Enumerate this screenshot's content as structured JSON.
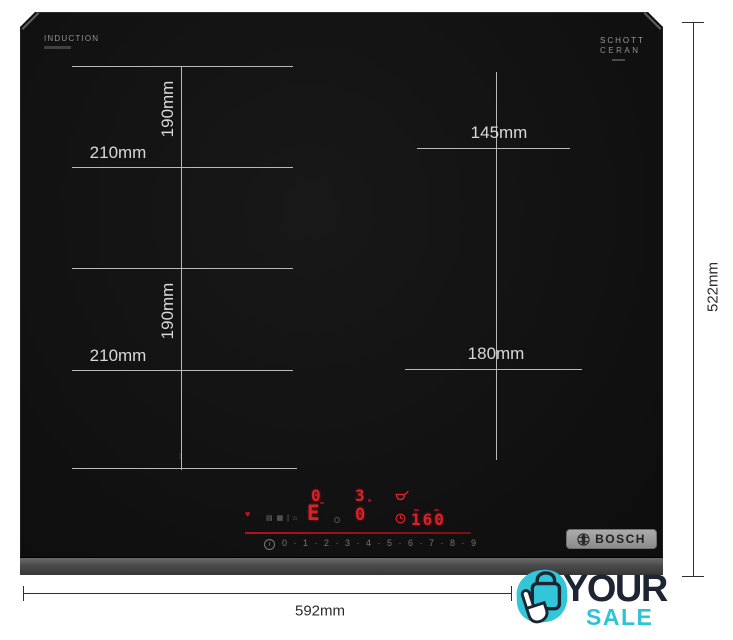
{
  "product": {
    "surface_label": "INDUCTION",
    "brand": "BOSCH",
    "glass_brand_line1": "SCHOTT",
    "glass_brand_line2": "CERAN"
  },
  "measurements": {
    "zone_height": "190mm",
    "zone_width": "210mm",
    "small_zone_width": "145mm",
    "mid_zone_width": "180mm",
    "total_height": "522mm",
    "total_width": "592mm"
  },
  "control_panel": {
    "display_top_left": "0",
    "display_top_right": "3",
    "display_selector": "E",
    "display_mid_right": "0",
    "timer_display": "160",
    "info_symbol": "i",
    "power_scale": [
      "0",
      "1",
      "2",
      "3",
      "4",
      "5",
      "6",
      "7",
      "8",
      "9"
    ],
    "power_scale_text": "0 · 1 · 2 · 3 · 4 · 5 · 6 · 7 · 8 · 9",
    "heat_indicator": "♥",
    "aux_icons_text": "▤ ▦ | ⌂",
    "flex_marker_text": "⌇"
  },
  "watermark": {
    "word_top": "YOUR",
    "word_bottom": "SALE"
  },
  "colors": {
    "glass": "#131313",
    "accent_red": "#dd2029",
    "teal": "#2fc3d6",
    "navy": "#1d2533",
    "glass_dim_line": "#b9b9b9",
    "external_dim_line": "#2f2f2f",
    "badge_gray": "#9a9a9a"
  }
}
